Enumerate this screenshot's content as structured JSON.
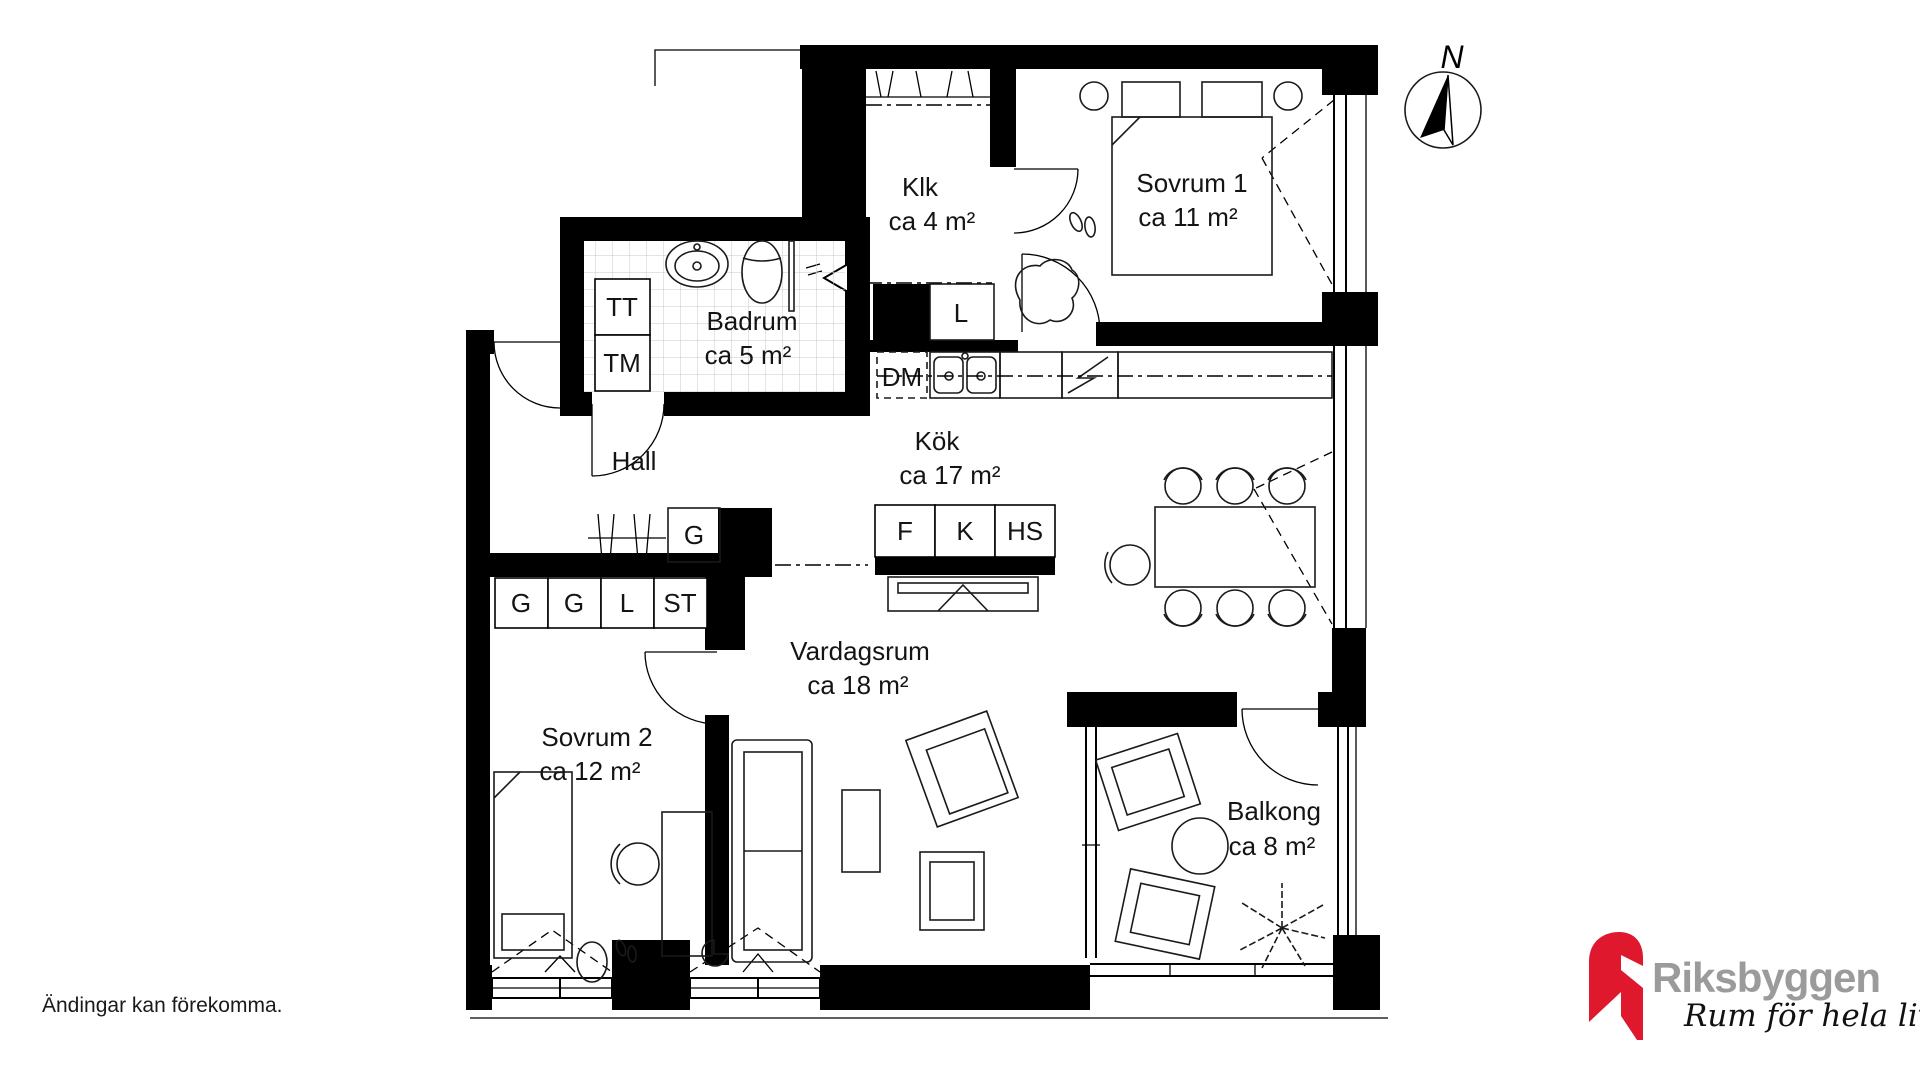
{
  "page": {
    "background": "#ffffff",
    "line_color": "#000000",
    "wall_color": "#000000"
  },
  "rooms": {
    "klk": {
      "name": "Klk",
      "area": "ca 4 m²"
    },
    "sovrum1": {
      "name": "Sovrum 1",
      "area": "ca 11 m²"
    },
    "badrum": {
      "name": "Badrum",
      "area": "ca 5 m²"
    },
    "hall": {
      "name": "Hall"
    },
    "kok": {
      "name": "Kök",
      "area": "ca 17 m²"
    },
    "vardagsrum": {
      "name": "Vardagsrum",
      "area": "ca 18 m²"
    },
    "sovrum2": {
      "name": "Sovrum 2",
      "area": "ca 12 m²"
    },
    "balkong": {
      "name": "Balkong",
      "area": "ca 8 m²"
    }
  },
  "fixtures": {
    "tt": "TT",
    "tm": "TM",
    "linen_closet": "L",
    "dm": "DM",
    "hall_wardrobe": "G",
    "fridge": "F",
    "freezer": "K",
    "tall_cabinet": "HS",
    "wardrobe_1": "G",
    "wardrobe_2": "G",
    "closet_l": "L",
    "cleaning_closet": "ST"
  },
  "compass": {
    "label": "N"
  },
  "branding": {
    "company": "Riksbyggen",
    "tagline": "Rum för hela livet",
    "brand_red": "#E0182D",
    "brand_gray": "#9B9B9B"
  },
  "disclaimer": "Ändingar kan förekomma."
}
